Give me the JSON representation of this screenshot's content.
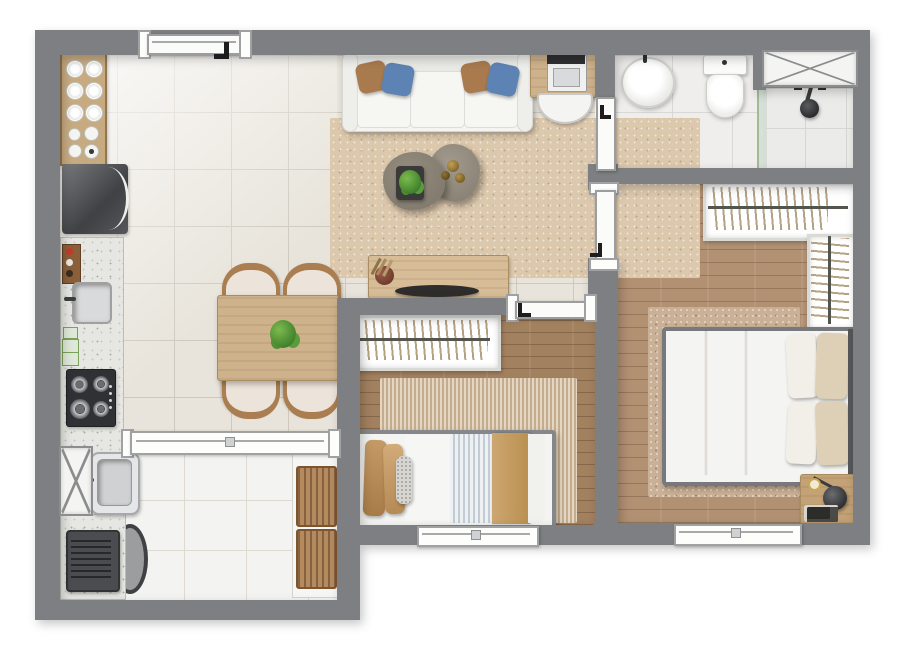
{
  "scene": {
    "type": "apartment-floor-plan-render",
    "view": "top-down",
    "rendered_text": ""
  },
  "palette": {
    "background": "#ffffff",
    "wall_gray": "#7d7f82",
    "tile_cream": "#e8e4db",
    "laundry_tile": "#f3f3f1",
    "wood_master": "#b29173",
    "wood_bedroom2": "#a2815f",
    "rug_beige": "#dcc8ac",
    "furniture_wood": "#cdb28c",
    "granite": "#e6e6e2",
    "sofa_white": "#f4f4f2",
    "pillow_brown": "#a87a4e",
    "pillow_blue": "#5d83b4",
    "blanket_tan": "#c49a66",
    "coffee_table_taupe": "#8b8376",
    "plant_green": "#4f8f3a",
    "appliance_dark": "#3a3c3f",
    "shower_glass_green": "#9dbd92"
  },
  "rooms": {
    "living": {
      "label": "Living room",
      "furniture": [
        "three-seat sofa",
        "4 throw pillows",
        "area rug",
        "2 pebble coffee tables",
        "potted plant",
        "desk with appliance",
        "desk chair",
        "sideboard with tray and dried plant"
      ]
    },
    "dining": {
      "label": "Dining area",
      "furniture": [
        "wood dining table",
        "4 chairs",
        "center plant"
      ]
    },
    "kitchen": {
      "label": "Kitchen",
      "furniture": [
        "dish cabinet with 6 plates and cups",
        "refrigerator",
        "granite counter",
        "inox sink",
        "spice rack",
        "cutting boards",
        "4-burner cooktop"
      ]
    },
    "laundry": {
      "label": "Laundry / service area",
      "furniture": [
        "duct shaft",
        "laundry tub",
        "granite counter",
        "washing machine",
        "round basket",
        "2 wooden drying racks",
        "sliding pass-through window"
      ]
    },
    "bathroom": {
      "label": "Bathroom",
      "furniture": [
        "oval washbasin",
        "toilet",
        "shower with glass partition",
        "duct shaft"
      ]
    },
    "master_bedroom": {
      "label": "Master bedroom",
      "furniture": [
        "double bed with beige duvet",
        "4 pillows",
        "L-shaped open wardrobe with hangers",
        "area rug",
        "nightstand",
        "black lamp",
        "books tray",
        "window"
      ]
    },
    "bedroom2": {
      "label": "Bedroom 2",
      "furniture": [
        "single bed",
        "tan pillows",
        "striped duvet",
        "open wardrobe with hangers",
        "area rug",
        "window"
      ]
    },
    "hall": {
      "label": "Hall",
      "furniture": []
    }
  },
  "openings": {
    "entry_door": "top wall above kitchen",
    "bathroom_door": "left bathroom wall",
    "master_door": "hall wall",
    "bedroom2_door": "hall wall",
    "windows": [
      "bedroom 2 bottom wall",
      "master bedroom bottom wall",
      "kitchen-laundry pass-through"
    ]
  },
  "counts": {
    "sofa_pillows": 4,
    "dining_chairs": 4,
    "master_bed_pillows": 4,
    "plates": 6,
    "cooktop_burners": 4,
    "coffee_tables": 2,
    "drying_racks": 2,
    "duct_shafts": 2,
    "doors": 4,
    "windows": 3
  }
}
